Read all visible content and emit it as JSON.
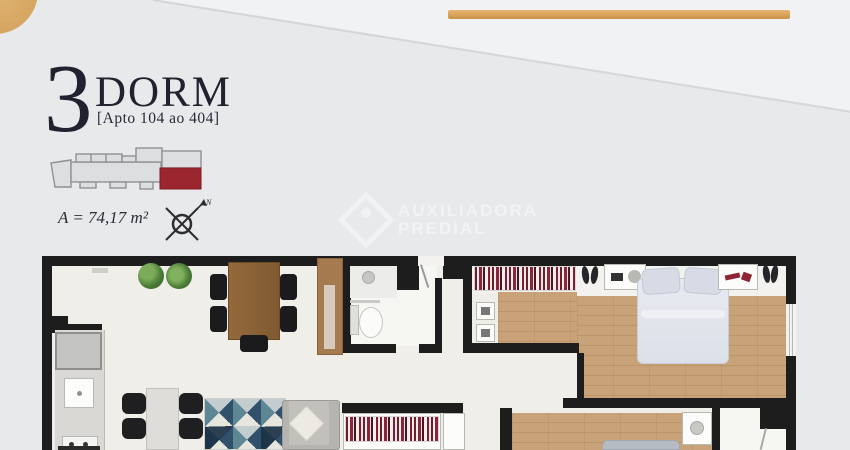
{
  "header": {
    "big_number": "3",
    "title": "DORM",
    "subtitle": "[Apto 104 ao 404]",
    "area": "A = 74,17 m²"
  },
  "compass": {
    "north": "N"
  },
  "watermark": {
    "line1": "AUXILIADORA",
    "line2": "PREDIAL"
  },
  "key_plan": {
    "highlighted_unit_color": "#9b2630",
    "building_fill": "#dcdee0",
    "building_outline": "#8f9295"
  },
  "floor_plan": {
    "wall_color": "#1d1d1d",
    "living_floor_color": "#efeee8",
    "wood_floor_color": "#c8a379",
    "rug_colors": [
      "#31506b",
      "#5d8795",
      "#e6e6df",
      "#c3cdcf"
    ]
  },
  "decor": {
    "accent_gold": "#d8a55f",
    "background_color": "#e7e9eb"
  }
}
